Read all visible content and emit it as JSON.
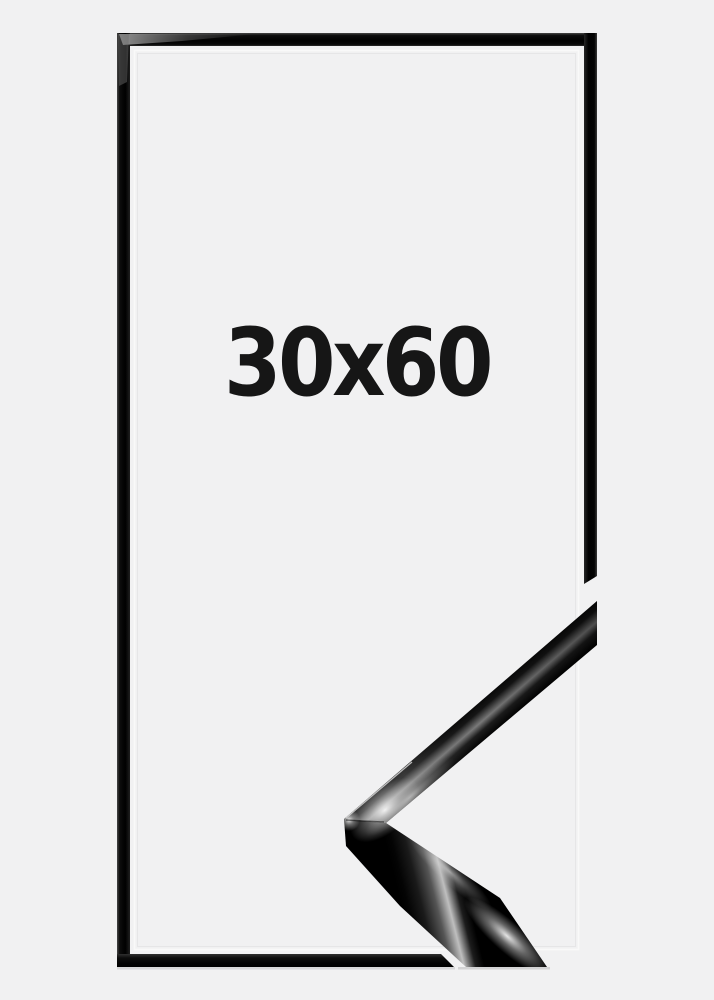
{
  "product": {
    "size_label": "30x60"
  },
  "visual": {
    "elements": [
      "thin-black-frame-front-view",
      "frame-corner-profile-sample-overlay"
    ]
  },
  "colors": {
    "background": "#f1f1f2",
    "frame_black": "#0a0a0a",
    "label_text": "#161616",
    "specular_silver": "#c8c8c8"
  }
}
